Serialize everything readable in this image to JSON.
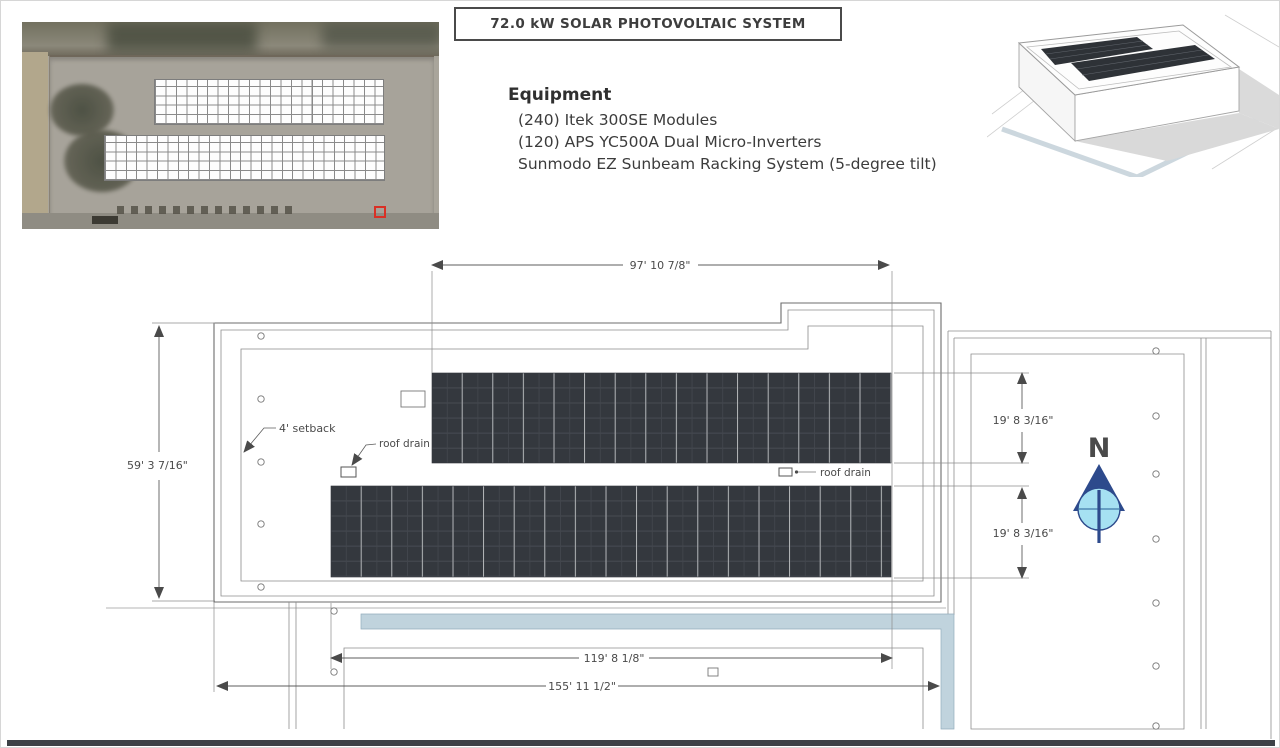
{
  "sheet": {
    "title": "72.0 kW SOLAR PHOTOVOLTAIC SYSTEM"
  },
  "equipment": {
    "heading": "Equipment",
    "items": [
      "(240) Itek 300SE Modules",
      "(120) APS YC500A Dual Micro-Inverters",
      "Sunmodo EZ Sunbeam Racking System (5-degree tilt)"
    ]
  },
  "plan": {
    "dimensions": {
      "top_array_width": "97' 10 7/8\"",
      "roof_height": "59' 3 7/16\"",
      "upper_array_depth": "19' 8 3/16\"",
      "lower_array_depth": "19' 8 3/16\"",
      "lower_array_width": "119' 8 1/8\"",
      "overall_width": "155' 11 1/2\""
    },
    "labels": {
      "setback": "4' setback",
      "roof_drain_left": "roof drain",
      "roof_drain_right": "roof drain"
    },
    "compass": {
      "north_label": "N"
    },
    "arrays": {
      "count": 2,
      "rows_per_array": 6
    }
  },
  "colors": {
    "panel_dark": "#34383e",
    "compass_navy": "#2d4a8c",
    "compass_cyan": "#a6e1f2",
    "walkway_blue": "#c0d3dd",
    "marker_red": "#d93025"
  }
}
